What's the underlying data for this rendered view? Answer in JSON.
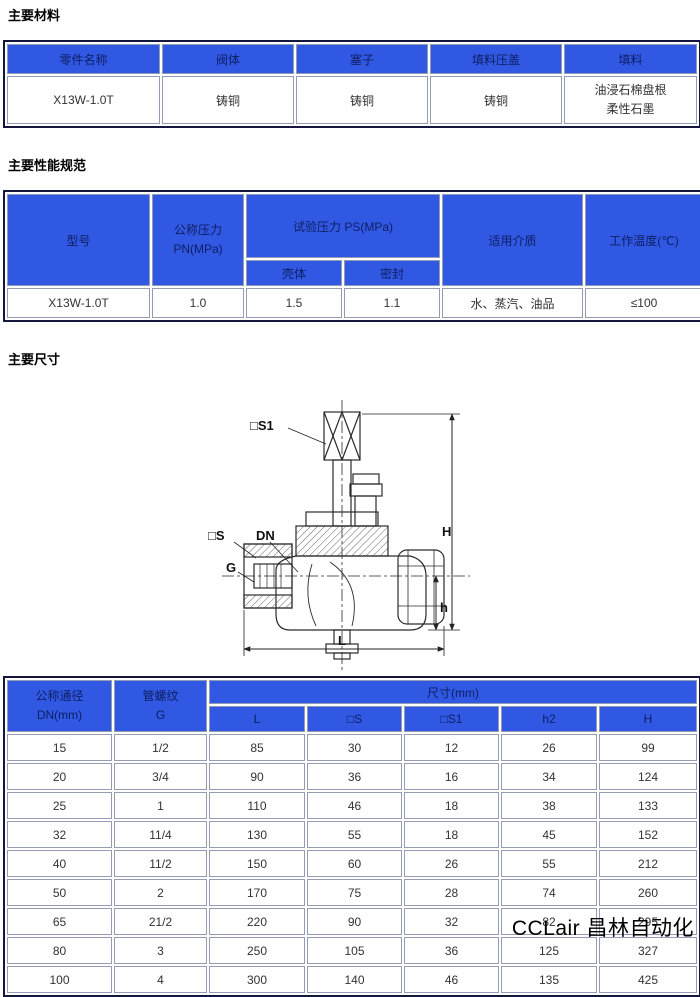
{
  "materials": {
    "title": "主要材料",
    "headers": [
      "零件名称",
      "阀体",
      "塞子",
      "填料压盖",
      "填料"
    ],
    "row": [
      "X13W-1.0T",
      "铸铜",
      "铸铜",
      "铸铜",
      "油浸石棉盘根\n柔性石墨"
    ]
  },
  "performance": {
    "title": "主要性能规范",
    "headers": {
      "model": "型号",
      "pn": "公称压力\nPN(MPa)",
      "test": "试验压力 PS(MPa)",
      "shell": "壳体",
      "seal": "密封",
      "medium": "适用介质",
      "temp": "工作温度(℃)"
    },
    "row": [
      "X13W-1.0T",
      "1.0",
      "1.5",
      "1.1",
      "水、蒸汽、油品",
      "≤100"
    ]
  },
  "dimensions": {
    "title": "主要尺寸",
    "headers": {
      "dn": "公称通径\nDN(mm)",
      "g": "管螺纹\nG",
      "size": "尺寸(mm)",
      "sub": [
        "L",
        "□S",
        "□S1",
        "h2",
        "H"
      ]
    },
    "rows": [
      [
        "15",
        "1/2",
        "85",
        "30",
        "12",
        "26",
        "99"
      ],
      [
        "20",
        "3/4",
        "90",
        "36",
        "16",
        "34",
        "124"
      ],
      [
        "25",
        "1",
        "110",
        "46",
        "18",
        "38",
        "133"
      ],
      [
        "32",
        "11/4",
        "130",
        "55",
        "18",
        "45",
        "152"
      ],
      [
        "40",
        "11/2",
        "150",
        "60",
        "26",
        "55",
        "212"
      ],
      [
        "50",
        "2",
        "170",
        "75",
        "28",
        "74",
        "260"
      ],
      [
        "65",
        "21/2",
        "220",
        "90",
        "32",
        "82",
        "295"
      ],
      [
        "80",
        "3",
        "250",
        "105",
        "36",
        "125",
        "327"
      ],
      [
        "100",
        "4",
        "300",
        "140",
        "46",
        "135",
        "425"
      ]
    ]
  },
  "diagram": {
    "labels": {
      "s1": "□S1",
      "s": "□S",
      "dn": "DN",
      "g": "G",
      "H": "H",
      "h": "h",
      "L": "L"
    }
  },
  "watermark": "CCLair 昌林自动化",
  "colors": {
    "header_bg": "#3158e2",
    "header_text": "#0d1e62",
    "border_outer": "#15173f",
    "border_cell": "#949cb4"
  }
}
